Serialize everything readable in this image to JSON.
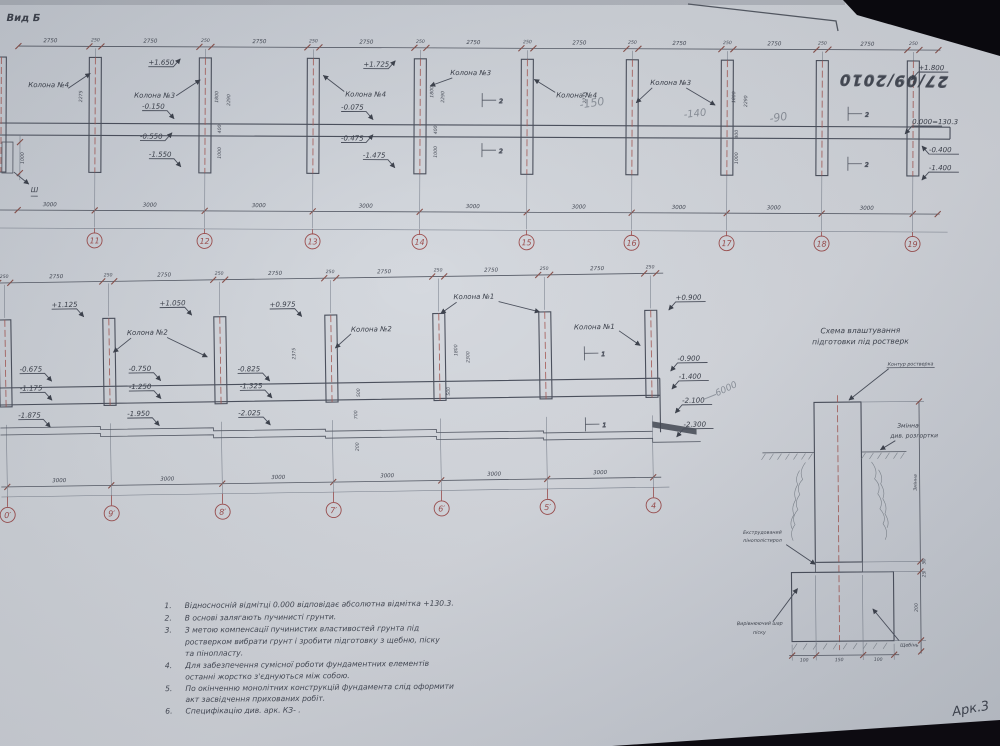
{
  "photo": {
    "date_stamp": "27/09/2010",
    "sheet_label": "Арк.3"
  },
  "top_view": {
    "title": "Вид Б",
    "axes": [
      "11",
      "12",
      "13",
      "14",
      "15",
      "16",
      "17",
      "18",
      "19"
    ],
    "bay_dim": "2750",
    "col_dim": "250",
    "span_dim": "3000",
    "col_labels": [
      "Колона №4",
      "Колона №3",
      "Колона №4",
      "Колона №3",
      "Колона №4",
      "Колона №3"
    ],
    "levels": [
      "+1.650",
      "-0.150",
      "-0.550",
      "-1.550",
      "+1.725",
      "-0.075",
      "-0.475",
      "-1.475",
      "+1.800",
      "0.000=130.3",
      "-0.400",
      "-1.400"
    ],
    "vdims": [
      "2275",
      "1800",
      "2290",
      "400",
      "1000",
      "2775"
    ],
    "pencil": [
      "-150",
      "-140",
      "-90"
    ],
    "section": "2",
    "left_mark": "Ш"
  },
  "mid_view": {
    "axes": [
      "0′",
      "9′",
      "8′",
      "7′",
      "6′",
      "5′",
      "4"
    ],
    "bay_dim": "2750",
    "col_dim": "250",
    "span_dim": "3000",
    "col_labels": [
      "Колона №2",
      "Колона №2",
      "Колона №1",
      "Колона №1"
    ],
    "levels": [
      "+1.125",
      "+1.050",
      "+0.975",
      "+0.900",
      "-0.675",
      "-1.175",
      "-1.875",
      "-0.750",
      "-1.250",
      "-1.950",
      "-0.825",
      "-1.325",
      "-2.025",
      "-0.900",
      "-1.400",
      "-2.100",
      "-2.300"
    ],
    "vdims": [
      "2375",
      "1800",
      "2300",
      "500",
      "700",
      "200"
    ],
    "pencil": "6000",
    "section": "1"
  },
  "detail": {
    "title1": "Схема влаштування",
    "title2": "підготовки під ростверк",
    "contour_label": "Контур ростверка",
    "var_label1": "Змінна",
    "var_label2": "див. розгортки",
    "eps_label1": "Екструдований",
    "eps_label2": "пінополістирол",
    "sand_label1": "Вирівнюючий шар",
    "sand_label2": "піску",
    "gravel_label": "Щебінь",
    "dim_var": "Змінна",
    "dim_50": "50",
    "dim_25": "25",
    "dim_200": "200",
    "dim_w1": "100",
    "dim_w2": "150",
    "dim_w3": "100"
  },
  "notes": {
    "items": [
      {
        "num": "1.",
        "lines": [
          "Відносносній відмітці 0.000 відповідає абсолютна відмітка +130.3."
        ]
      },
      {
        "num": "2.",
        "lines": [
          "В основі залягають пучинисті грунти."
        ]
      },
      {
        "num": "3.",
        "lines": [
          "З метою компенсації пучинистих властивостей грунта під",
          "ростверком вибрати грунт і зробити підготовку з щебню, піску",
          "та пінопласту."
        ]
      },
      {
        "num": "4.",
        "lines": [
          "Для  забезпечення сумісної роботи фундаментних елементів",
          "останні жорстко з'єднуються між собою."
        ]
      },
      {
        "num": "5.",
        "lines": [
          "По окінченню монолітних конструкцій фундамента слід оформити",
          "акт засвідчення прихованих робіт."
        ]
      },
      {
        "num": "6.",
        "lines": [
          "Специфікацію див. арк. КЗ-   ."
        ]
      }
    ]
  }
}
